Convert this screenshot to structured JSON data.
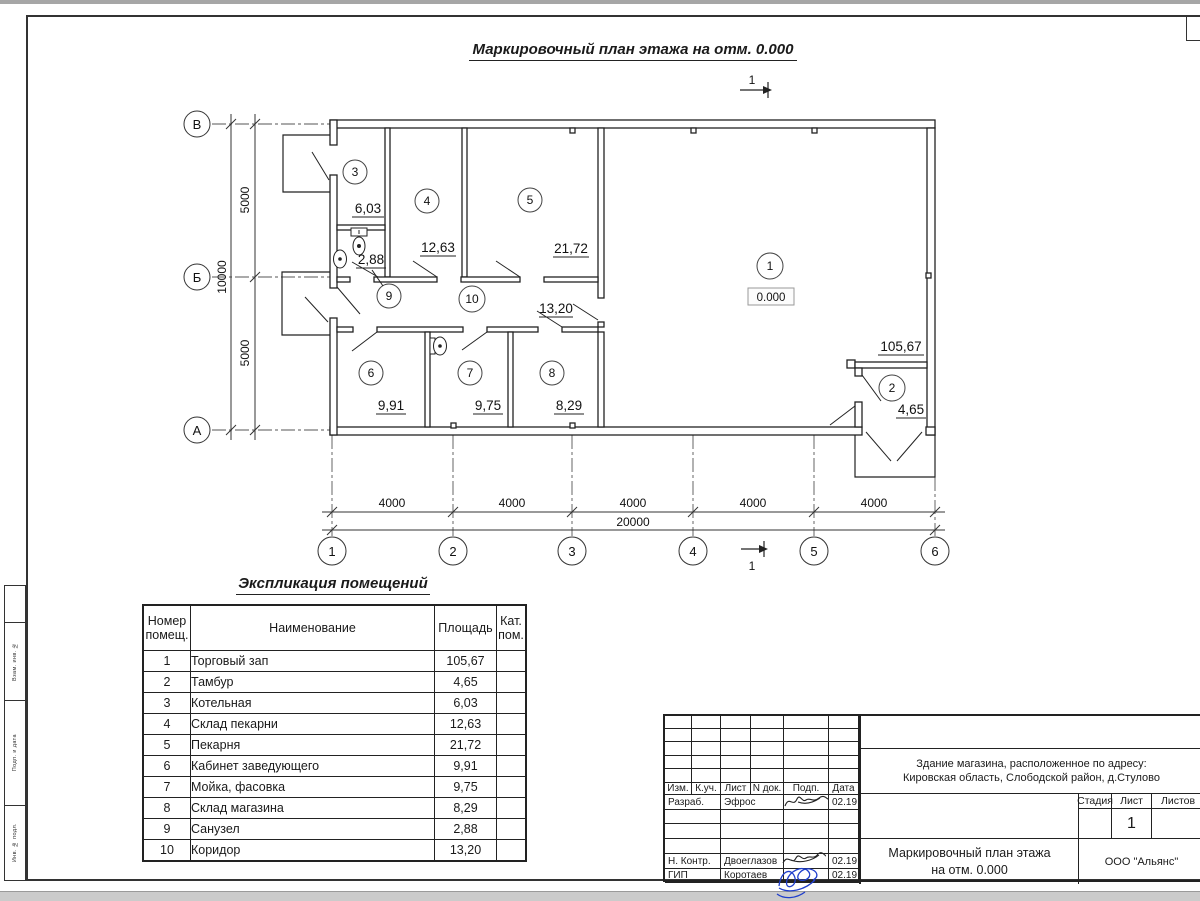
{
  "drawing": {
    "title": "Маркировочный план этажа на отм. 0.000",
    "section_label": "1",
    "elevation": "0.000"
  },
  "plan": {
    "rooms": [
      {
        "number": "1",
        "area": "105,67"
      },
      {
        "number": "2",
        "area": "4,65"
      },
      {
        "number": "3",
        "area": "6,03"
      },
      {
        "number": "4",
        "area": "12,63"
      },
      {
        "number": "5",
        "area": "21,72"
      },
      {
        "number": "6",
        "area": "9,91"
      },
      {
        "number": "7",
        "area": "9,75"
      },
      {
        "number": "8",
        "area": "8,29"
      },
      {
        "number": "9",
        "area": "2,88"
      },
      {
        "number": "10",
        "area": "13,20"
      }
    ],
    "axes_h": [
      "1",
      "2",
      "3",
      "4",
      "5",
      "6"
    ],
    "axes_v": [
      "В",
      "Б",
      "А"
    ],
    "dims_bottom": [
      "4000",
      "4000",
      "4000",
      "4000",
      "4000"
    ],
    "dim_bottom_total": "20000",
    "dims_left": [
      "5000",
      "5000"
    ],
    "dim_left_total": "10000"
  },
  "schedule": {
    "title": "Экспликация помещений",
    "columns": [
      "Номер помещ.",
      "Наименование",
      "Площадь",
      "Кат. пом."
    ],
    "rows": [
      {
        "num": "1",
        "name": "Торговый зап",
        "area": "105,67",
        "cat": ""
      },
      {
        "num": "2",
        "name": "Тамбур",
        "area": "4,65",
        "cat": ""
      },
      {
        "num": "3",
        "name": "Котельная",
        "area": "6,03",
        "cat": ""
      },
      {
        "num": "4",
        "name": "Склад пекарни",
        "area": "12,63",
        "cat": ""
      },
      {
        "num": "5",
        "name": "Пекарня",
        "area": "21,72",
        "cat": ""
      },
      {
        "num": "6",
        "name": "Кабинет заведующего",
        "area": "9,91",
        "cat": ""
      },
      {
        "num": "7",
        "name": "Мойка, фасовка",
        "area": "9,75",
        "cat": ""
      },
      {
        "num": "8",
        "name": "Склад магазина",
        "area": "8,29",
        "cat": ""
      },
      {
        "num": "9",
        "name": "Санузел",
        "area": "2,88",
        "cat": ""
      },
      {
        "num": "10",
        "name": "Коридор",
        "area": "13,20",
        "cat": ""
      }
    ]
  },
  "titleblock": {
    "header_cells": [
      "Изм.",
      "К.уч.",
      "Лист",
      "N док.",
      "Подп.",
      "Дата"
    ],
    "sign_rows": [
      {
        "role": "Разраб.",
        "name": "Эфрос",
        "date": "02.19"
      },
      {
        "role": "",
        "name": "",
        "date": ""
      },
      {
        "role": "",
        "name": "",
        "date": ""
      },
      {
        "role": "",
        "name": "",
        "date": ""
      },
      {
        "role": "Н. Контр.",
        "name": "Двоеглазов",
        "date": "02.19"
      },
      {
        "role": "ГИП",
        "name": "Коротаев",
        "date": "02.19"
      }
    ],
    "address_line1": "Здание магазина, расположенное по адресу:",
    "address_line2": "Кировская область, Слободской район, д.Стулово",
    "stage_label": "Стадия",
    "sheet_label": "Лист",
    "sheets_label": "Листов",
    "sheet_number": "1",
    "doc_title_line1": "Маркировочный план этажа",
    "doc_title_line2": "на отм. 0.000",
    "company": "ООО \"Альянс\""
  },
  "frame": {
    "side_labels": [
      "Взам. инв. №",
      "Подп. и дата",
      "Инв. № подл."
    ]
  }
}
